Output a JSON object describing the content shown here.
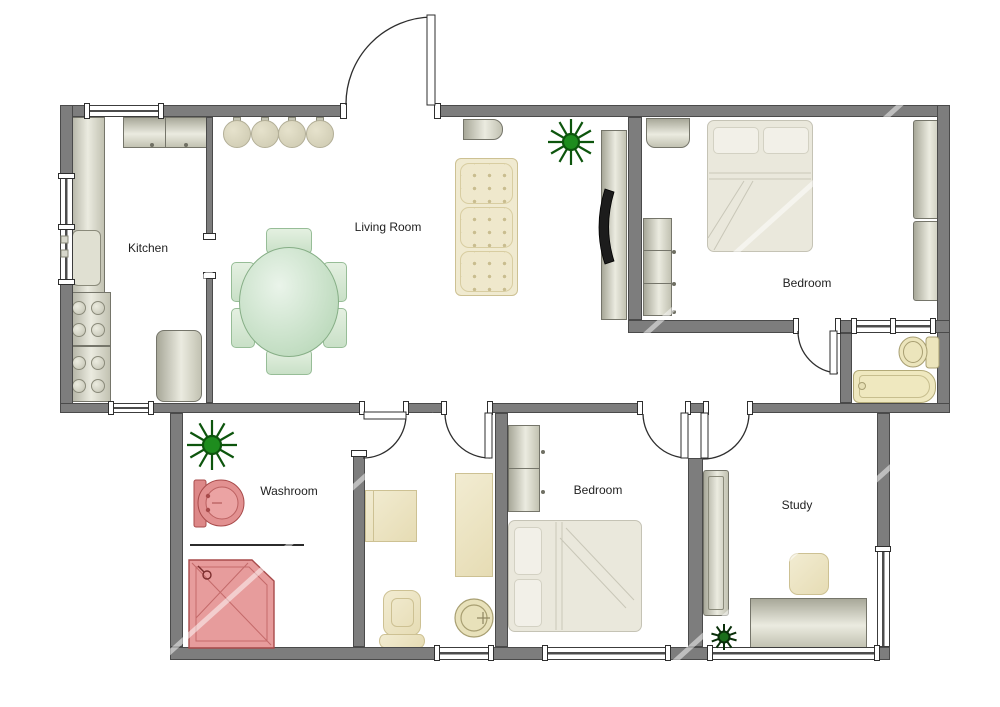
{
  "plan": {
    "type": "floorplan",
    "rooms": {
      "kitchen": {
        "label": "Kitchen"
      },
      "living_room": {
        "label": "Living Room"
      },
      "bedroom_top": {
        "label": "Bedroom"
      },
      "washroom": {
        "label": "Washroom"
      },
      "bedroom_bottom": {
        "label": "Bedroom"
      },
      "study": {
        "label": "Study"
      }
    },
    "furniture": {
      "kitchen": [
        "counter",
        "sink",
        "stove-burners",
        "upper-cabinet",
        "refrigerator"
      ],
      "living_room": [
        "ceiling-lights",
        "sofa",
        "dining-table",
        "dining-chairs",
        "tv",
        "tv-console",
        "wall-heater",
        "plant"
      ],
      "bedroom_top": [
        "double-bed",
        "nightstand",
        "dresser",
        "wardrobe"
      ],
      "bathroom": [
        "toilet",
        "bathtub"
      ],
      "washroom": [
        "wash-basin",
        "shower",
        "plant"
      ],
      "utility_room": [
        "cabinet",
        "counter",
        "chair",
        "round-basin"
      ],
      "bedroom_bottom": [
        "double-bed",
        "cabinet"
      ],
      "study": [
        "desk",
        "chair",
        "bookshelf",
        "plant"
      ]
    }
  },
  "colors": {
    "wall": "#7d7d7d",
    "wall_border": "#4a4a4a",
    "beige": "#efe9cd",
    "beige_border": "#cdc193",
    "green": "#d9ebd6",
    "green_border": "#97bd97",
    "red": "#e29191",
    "red_border": "#a84b4b",
    "plant": "#1e8c1e"
  }
}
